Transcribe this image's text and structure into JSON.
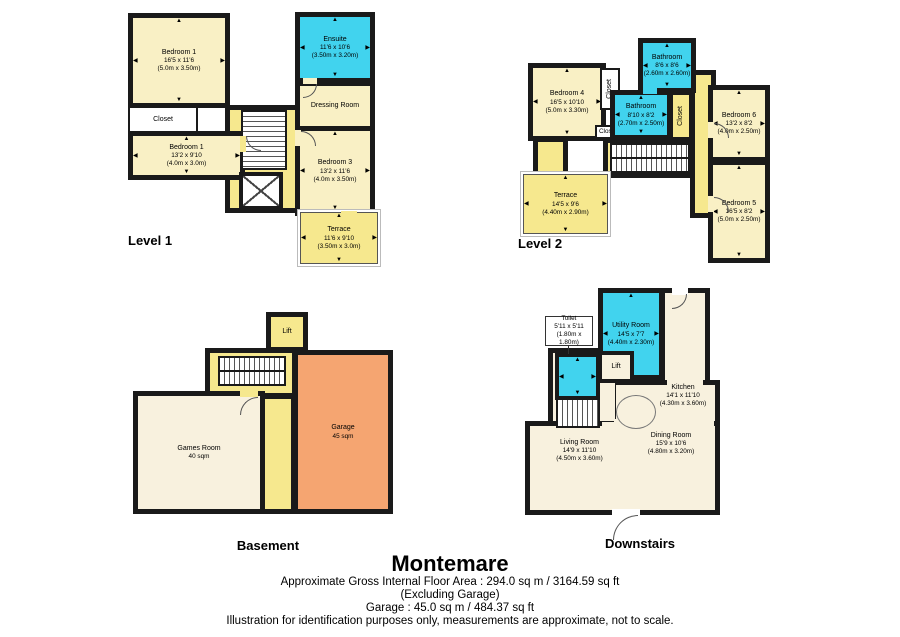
{
  "palette": {
    "wall": "#1a1a1a",
    "room_pale_yellow": "#F9F0C5",
    "hall_bright_yellow": "#F6E88E",
    "wet_room_cyan": "#41D3EE",
    "living_cream": "#F8F1DE",
    "garage_orange": "#F5A571",
    "background": "#FFFFFF"
  },
  "plans": {
    "level1": {
      "label": "Level 1",
      "rooms": {
        "bedroom1a": {
          "name": "Bedroom 1",
          "dims": "16'5 x 11'6",
          "metric": "(5.0m x 3.50m)"
        },
        "closet": {
          "name": "Closet"
        },
        "bedroom1b": {
          "name": "Bedroom 1",
          "dims": "13'2 x 9'10",
          "metric": "(4.0m x 3.0m)"
        },
        "ensuite": {
          "name": "Ensuite",
          "dims": "11'6 x 10'6",
          "metric": "(3.50m x 3.20m)"
        },
        "dressing": {
          "name": "Dressing Room"
        },
        "bedroom3": {
          "name": "Bedroom 3",
          "dims": "13'2 x 11'6",
          "metric": "(4.0m x 3.50m)"
        },
        "terrace": {
          "name": "Terrace",
          "dims": "11'6 x 9'10",
          "metric": "(3.50m x 3.0m)"
        }
      }
    },
    "level2": {
      "label": "Level 2",
      "rooms": {
        "bedroom4": {
          "name": "Bedroom 4",
          "dims": "16'5 x 10'10",
          "metric": "(5.0m x 3.30m)"
        },
        "closet_top": {
          "name": "Closet"
        },
        "closet_small": {
          "name": "Closet"
        },
        "bathroom_a": {
          "name": "Bathroom",
          "dims": "8'6 x 8'6",
          "metric": "(2.60m x 2.60m)"
        },
        "bathroom_b": {
          "name": "Bathroom",
          "dims": "8'10 x 8'2",
          "metric": "(2.70m x 2.50m)"
        },
        "closet_mid": {
          "name": "Closet"
        },
        "bedroom6": {
          "name": "Bedroom 6",
          "dims": "13'2 x 8'2",
          "metric": "(4.0m x 2.50m)"
        },
        "bedroom5": {
          "name": "Bedroom 5",
          "dims": "16'5 x 8'2",
          "metric": "(5.0m x 2.50m)"
        },
        "terrace": {
          "name": "Terrace",
          "dims": "14'5 x 9'6",
          "metric": "(4.40m x 2.90m)"
        }
      }
    },
    "basement": {
      "label": "Basement",
      "rooms": {
        "lift": {
          "name": "Lift"
        },
        "games": {
          "name": "Games Room",
          "dims": "40 sqm"
        },
        "garage": {
          "name": "Garage",
          "dims": "45 sqm"
        }
      }
    },
    "downstairs": {
      "label": "Downstairs",
      "rooms": {
        "toilet": {
          "name": "Toilet",
          "dims": "5'11 x 5'11",
          "metric": "(1.80m x 1.80m)"
        },
        "utility": {
          "name": "Utility Room",
          "dims": "14'5 x 7'7",
          "metric": "(4.40m x 2.30m)"
        },
        "lift": {
          "name": "Lift"
        },
        "kitchen": {
          "name": "Kitchen",
          "dims": "14'1 x 11'10",
          "metric": "(4.30m x 3.60m)"
        },
        "living": {
          "name": "Living Room",
          "dims": "14'9 x 11'10",
          "metric": "(4.50m x 3.60m)"
        },
        "dining": {
          "name": "Dining Room",
          "dims": "15'9 x 10'6",
          "metric": "(4.80m x 3.20m)"
        }
      }
    }
  },
  "footer": {
    "title": "Montemare",
    "area_line": "Approximate Gross Internal Floor Area : 294.0 sq m / 3164.59 sq ft",
    "excluding_line": "(Excluding Garage)",
    "garage_line": "Garage : 45.0 sq m / 484.37 sq ft",
    "disclaimer": "Illustration for identification purposes only, measurements are approximate, not to scale."
  }
}
